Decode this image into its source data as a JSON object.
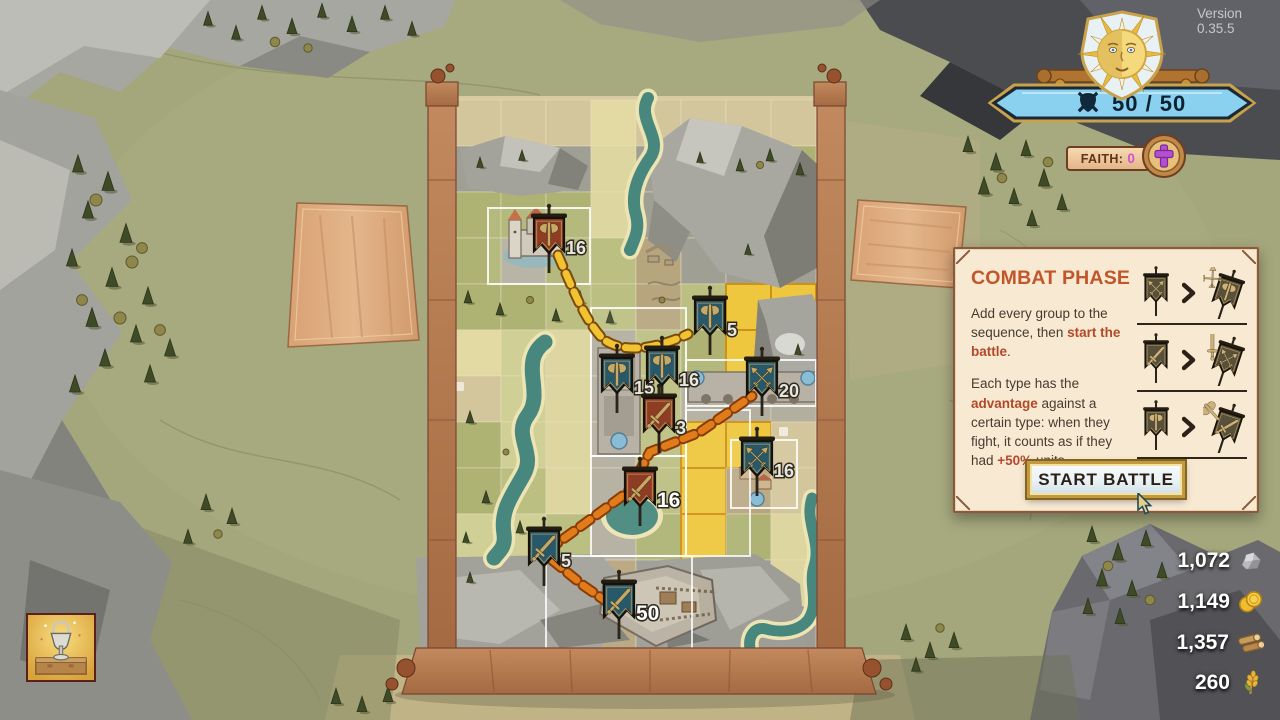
{
  "version_label": "Version 0.35.5",
  "hud": {
    "strength": {
      "value": "50 / 50",
      "icon": "crossed-sword-shield-icon"
    },
    "faith": {
      "label": "FAITH:",
      "value": "0",
      "icon": "cross-icon"
    },
    "emblem": "sun-face-emblem"
  },
  "combat_panel": {
    "title": "COMBAT PHASE",
    "p1": [
      {
        "t": "Add every group to the sequence, then "
      },
      {
        "t": "start the battle",
        "hl": true
      },
      {
        "t": "."
      }
    ],
    "p2": [
      {
        "t": "Each type has the "
      },
      {
        "t": "advantage",
        "hl": true
      },
      {
        "t": " against a certain type: when they fight, it counts as if they had "
      },
      {
        "t": "+50%",
        "hl": true
      },
      {
        "t": " units."
      }
    ],
    "advantages": [
      {
        "winner": "ranged",
        "loser": "axe"
      },
      {
        "winner": "sword",
        "loser": "ranged"
      },
      {
        "winner": "axe",
        "loser": "sword"
      }
    ],
    "button_label": "START BATTLE"
  },
  "resources": [
    {
      "name": "stone",
      "value": "1,072"
    },
    {
      "name": "gold",
      "value": "1,149"
    },
    {
      "name": "wood",
      "value": "1,357"
    },
    {
      "name": "wheat",
      "value": "260"
    }
  ],
  "board": {
    "flags": [
      {
        "count": "16",
        "team": "red",
        "type": "axe",
        "x": 549,
        "y": 240,
        "highlight": false
      },
      {
        "count": "5",
        "team": "blue",
        "type": "axe",
        "x": 710,
        "y": 322,
        "highlight": false
      },
      {
        "count": "15",
        "team": "blue",
        "type": "axe",
        "x": 617,
        "y": 380,
        "highlight": false
      },
      {
        "count": "16",
        "team": "blue",
        "type": "axe",
        "x": 662,
        "y": 372,
        "highlight": false
      },
      {
        "count": "3",
        "team": "red",
        "type": "sword",
        "x": 659,
        "y": 420,
        "highlight": false
      },
      {
        "count": "20",
        "team": "blue",
        "type": "ranged",
        "x": 762,
        "y": 383,
        "highlight": false
      },
      {
        "count": "16",
        "team": "blue",
        "type": "ranged",
        "x": 757,
        "y": 463,
        "highlight": false
      },
      {
        "count": "16",
        "team": "red",
        "type": "sword",
        "x": 640,
        "y": 493,
        "highlight": true
      },
      {
        "count": "5",
        "team": "blue",
        "type": "sword",
        "x": 544,
        "y": 553,
        "highlight": false
      },
      {
        "count": "50",
        "team": "blue",
        "type": "sword",
        "x": 619,
        "y": 606,
        "highlight": true
      }
    ]
  },
  "colors": {
    "panel_title": "#c2562b",
    "panel_highlight": "#b3492a",
    "faith_value": "#d44fd4",
    "hp_banner": "#8ad0ef",
    "flag_blue": "#27596a",
    "flag_red": "#8e3c24",
    "path_yellow": "#f1c330",
    "path_orange": "#e07d1a"
  },
  "icons": {
    "resource_stone": "stone-icon",
    "resource_gold": "gold-coins-icon",
    "resource_wood": "wood-logs-icon",
    "resource_wheat": "wheat-icon",
    "cursor": "arrow-cursor",
    "event_tile": "trophy-event-icon"
  }
}
